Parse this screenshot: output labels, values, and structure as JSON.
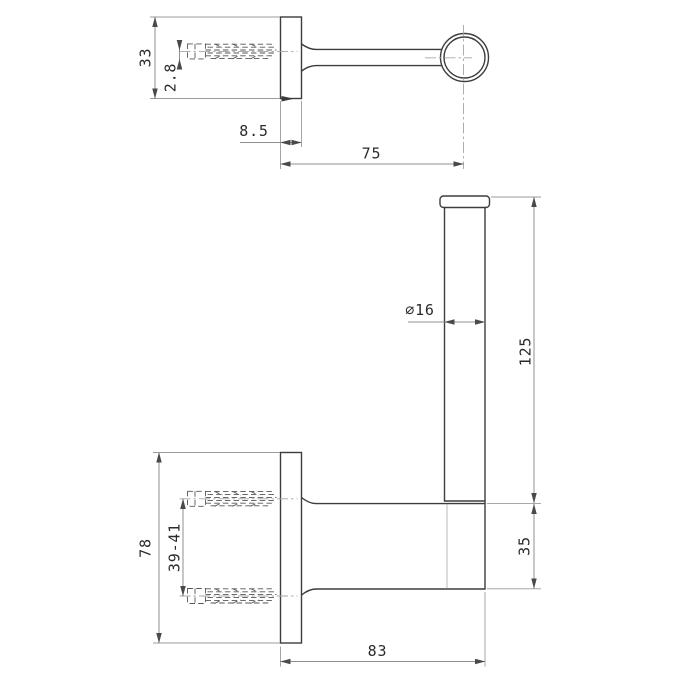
{
  "drawing": {
    "title": "wall-mounted spare roll holder technical drawing",
    "views": {
      "top": {
        "name": "top-view"
      },
      "front": {
        "name": "front-view"
      }
    }
  },
  "dimensions": {
    "plate_height": "33",
    "screw_axis_offset": "2.8",
    "plate_thickness": "8.5",
    "arm_reach": "75",
    "tube_diameter": "⌀16",
    "tube_length": "125",
    "backplate_height": "78",
    "mounting_hole_spacing": "39-41",
    "arm_section_height": "35",
    "overall_projection": "83"
  },
  "colors": {
    "object_line": "#3d3d3d",
    "dimension_line": "#8f8f8f",
    "centerline": "#a6a6a6",
    "hidden_line": "#565656",
    "text": "#2b2b2b",
    "background": "#ffffff"
  }
}
